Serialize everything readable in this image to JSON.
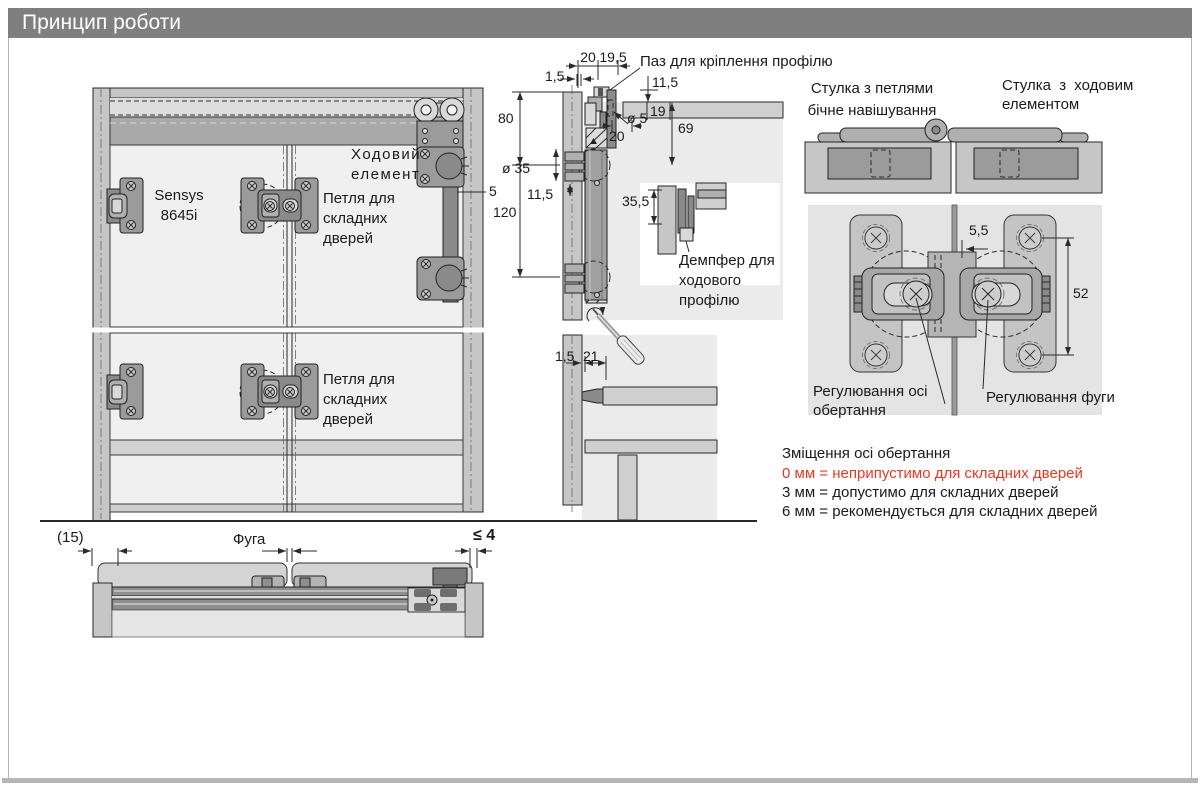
{
  "title_bar": {
    "title": "Принцип роботи"
  },
  "front_view": {
    "sensys_label": {
      "line1": "Sensys",
      "line2": "8645i"
    },
    "running_element_label": {
      "line1": "Ходовий",
      "line2": "елемент"
    },
    "folding_hinge_label_upper": {
      "line1": "Петля для",
      "line2": "складних",
      "line3": "дверей"
    },
    "folding_hinge_label_lower": {
      "line1": "Петля для",
      "line2": "складних",
      "line3": "дверей"
    },
    "dim_arm_offset": "5"
  },
  "section_view": {
    "groove_label": "Паз для кріплення профілю",
    "damper_label": {
      "line1": "Демпфер для",
      "line2": "ходового",
      "line3": "профілю"
    },
    "dims": {
      "top_20": "20",
      "top_19_5": "19,5",
      "top_1_5": "1,5",
      "top_11_5": "11,5",
      "panel_19": "19",
      "hole_dia_5": "ø 5",
      "front_20": "20",
      "panel_69": "69",
      "left_80": "80",
      "cup_dia_35": "ø 35",
      "left_11_5": "11,5",
      "left_120": "120",
      "inset_35_5": "35,5",
      "bottom_1_5": "1,5",
      "bottom_21": "21"
    }
  },
  "right_panel": {
    "leaf_hinges_label": {
      "line1": "Стулка з петлями",
      "line2": "бічне навішування"
    },
    "leaf_runner_label": {
      "line1": "Стулка з ходовим",
      "line2": "елементом"
    },
    "dims": {
      "gap_5_5": "5,5",
      "spacing_52": "52"
    },
    "axis_adjust_label": {
      "line1": "Регулювання осі",
      "line2": "обертання"
    },
    "gap_adjust_label": "Регулювання фуги",
    "offset_section": {
      "heading": "Зміщення осі обертання",
      "rule_0mm": "0 мм = неприпустимо для складних дверей",
      "rule_3mm": "3 мм = допустимо для складних дверей",
      "rule_6mm": "6 мм = рекомендується для складних дверей"
    }
  },
  "bottom_view": {
    "dim_side": "(15)",
    "gap_label": "Фуга",
    "dim_max": "≤ 4"
  },
  "colors": {
    "titlebar_bg": "#7f7f7f",
    "warning_red": "#e8391f",
    "line": "#2a2a2a"
  }
}
